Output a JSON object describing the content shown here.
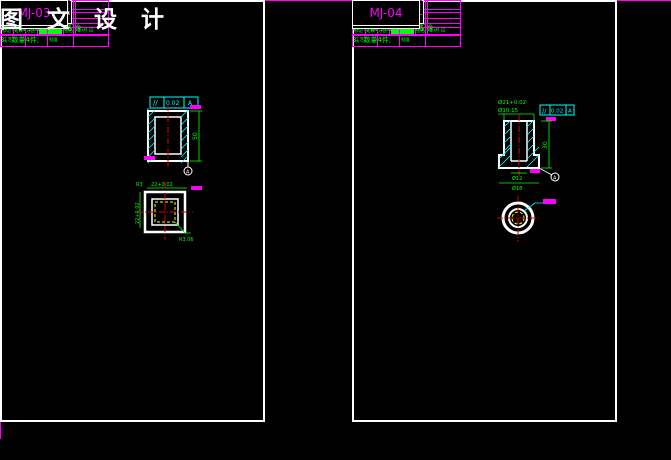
{
  "watermark": "图 文 设 计",
  "surface_note": {
    "rest": "其余",
    "value": "R6.3"
  },
  "corner_mark": {
    "check": "√",
    "paren": "( √ )"
  },
  "tech_requirements": {
    "title": "技术要求:",
    "item1": "1、热处理HRC60-62;",
    "item2": "2、外圆与固定板过盈配合;",
    "item3": "3、数量4件;"
  },
  "margin_fields": {
    "borrow_line1": "借(通)用",
    "borrow_line2": "件登记",
    "old_film": "旧底图总号",
    "film": "底图总号",
    "sign": "签名",
    "date1": "日期",
    "date2": "日期"
  },
  "title_block": {
    "mark": "标记",
    "count": "处数",
    "zone": "分区",
    "sign": "签名",
    "date": "年 月 日",
    "design": "设计",
    "check": "审核",
    "process": "工艺",
    "standard": "标准化",
    "weight": "重量",
    "ratio": "比例",
    "approve": "批准",
    "stage": "阶 段 标 记",
    "scale": "1:1"
  },
  "sheets": [
    {
      "material": "Cr12MoV",
      "part_name": "切角凹模镶块",
      "drawing_no": "MJ-03",
      "sheet_total": "共 14 张",
      "sheet_page": "第 05 张",
      "fcf_symbol": "//",
      "fcf_tol": "0.02",
      "fcf_datum": "A",
      "datum_label": "A",
      "dims": {
        "height": "50",
        "width": "22+0.02",
        "depth": "22+0.02",
        "corner": "R3",
        "leader": "R3.06"
      }
    },
    {
      "material": "Cr12MoV",
      "part_name": "冲孔凹模镶块",
      "drawing_no": "MJ-04",
      "sheet_total": "共 14 张",
      "sheet_page": "第 06 张",
      "fcf_symbol": "//",
      "fcf_tol": "0.02",
      "fcf_datum": "A",
      "datum_label": "A",
      "dims": {
        "top1": "Ø21+0.02",
        "top2": "Ø10.15",
        "height": "30",
        "bottom1": "Ø12",
        "bottom2": "Ø18"
      }
    }
  ],
  "colors": {
    "magenta": "#FF00FF",
    "green": "#00FF00",
    "cyan": "#00FFFF",
    "red": "#E00000",
    "yellow": "#FFFF00",
    "white": "#FFFFFF"
  }
}
